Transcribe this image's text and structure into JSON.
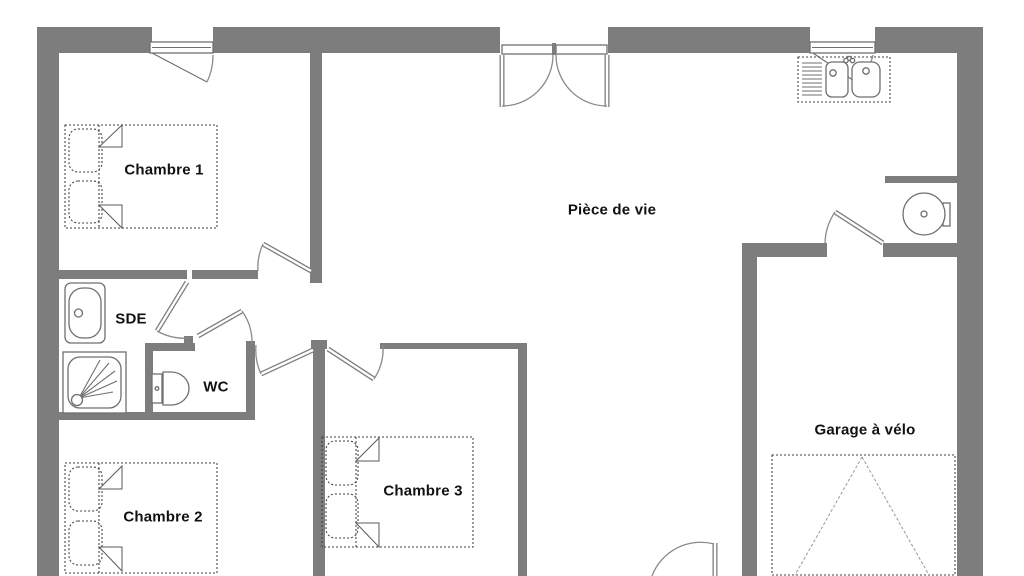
{
  "plan": {
    "labels": {
      "chambre1": "Chambre 1",
      "piece_de_vie": "Pièce de vie",
      "sde": "SDE",
      "wc": "WC",
      "chambre2": "Chambre 2",
      "chambre3": "Chambre 3",
      "garage": "Garage à vélo"
    },
    "colors": {
      "wall": "#7d7d7d",
      "furniture_line": "#6f6f6f",
      "dotted_line": "#3f3f3f",
      "door_arc": "#8a8a8a",
      "text": "#111111",
      "background": "#ffffff"
    },
    "fixtures": [
      "double-bed-chambre-1",
      "double-bed-chambre-2",
      "double-bed-chambre-3",
      "washbasin-sde",
      "shower-sde",
      "toilet-wc",
      "kitchen-double-sink",
      "water-heater",
      "bike-parking-area"
    ],
    "openings": [
      "window-chambre-1",
      "french-door-piece-de-vie",
      "window-kitchen",
      "door-chambre-1",
      "door-sde",
      "door-wc",
      "door-corridor",
      "door-chambre-3",
      "door-garage",
      "door-entrance"
    ]
  }
}
